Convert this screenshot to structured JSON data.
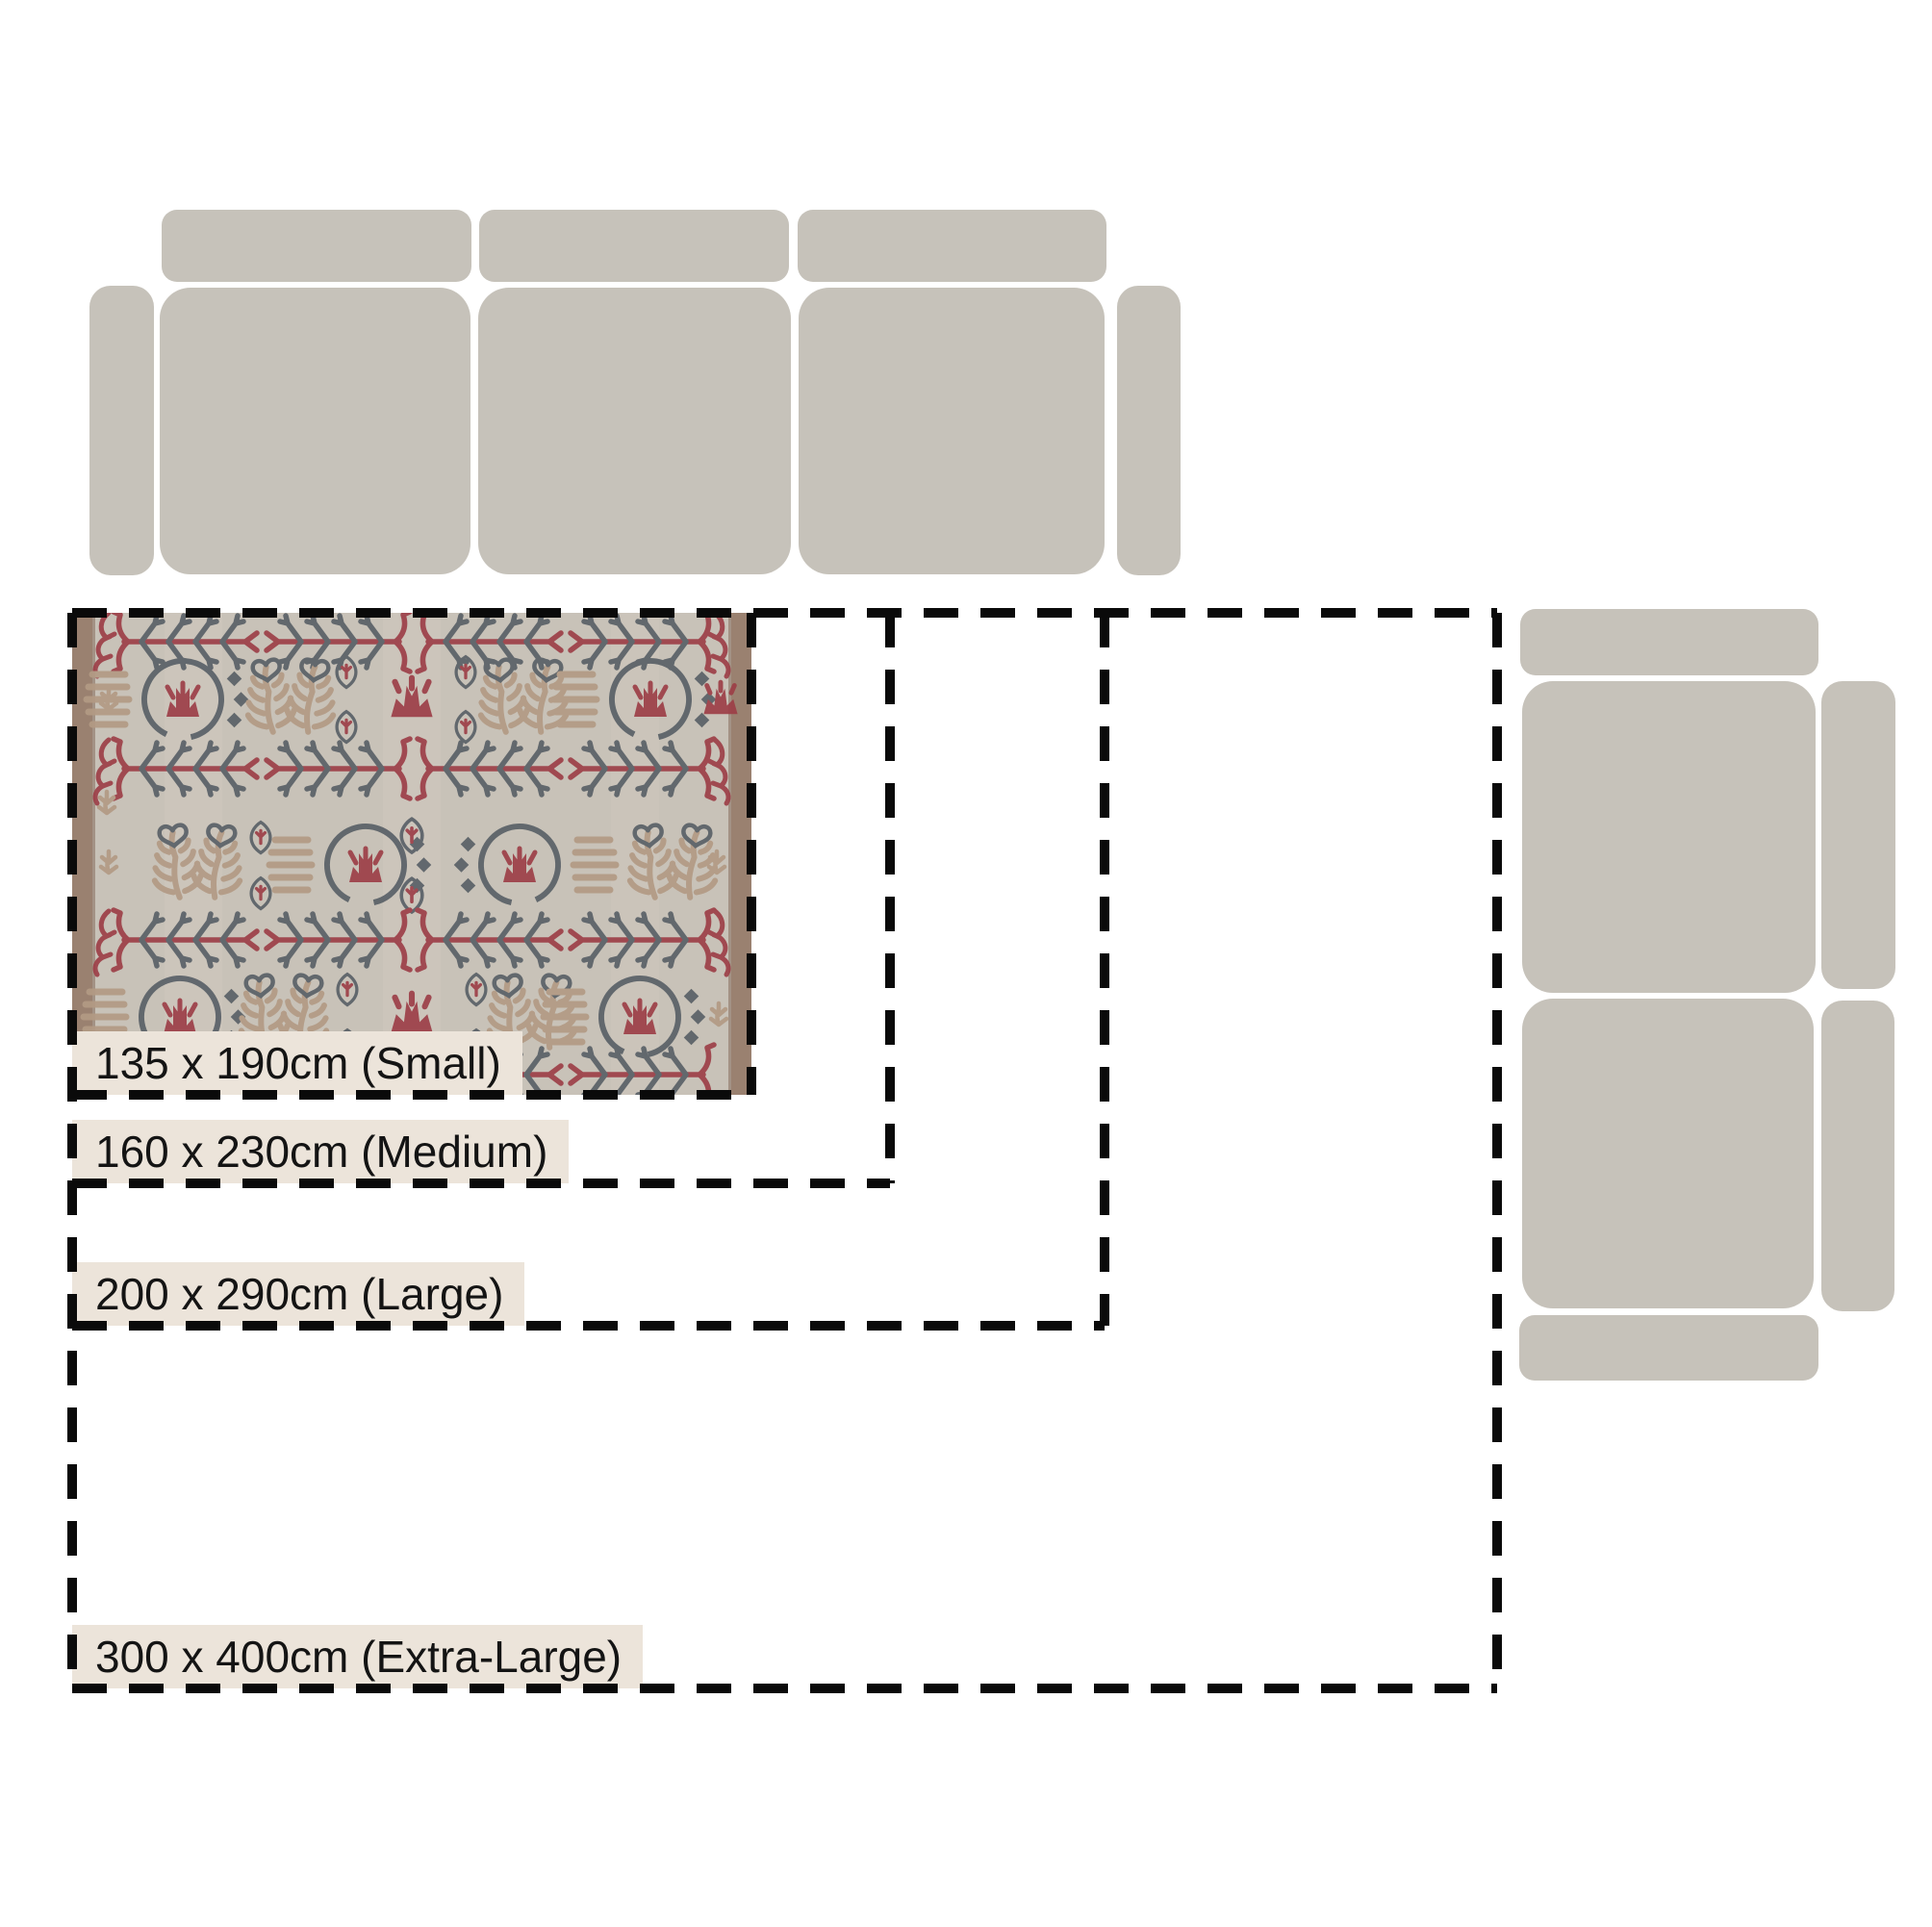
{
  "sizes": [
    {
      "name": "Small",
      "width_cm": 135,
      "length_cm": 190,
      "label": "135 x 190cm (Small)"
    },
    {
      "name": "Medium",
      "width_cm": 160,
      "length_cm": 230,
      "label": "160 x 230cm (Medium)"
    },
    {
      "name": "Large",
      "width_cm": 200,
      "length_cm": 290,
      "label": "200 x 290cm (Large)"
    },
    {
      "name": "Extra-Large",
      "width_cm": 300,
      "length_cm": 400,
      "label": "300 x 400cm (Extra-Large)"
    }
  ],
  "furniture": {
    "top_sofa": "three-seat-sofa-top-view",
    "right_sofa": "two-seat-sectional-sofa-top-view"
  },
  "colors": {
    "background": "#ffffff",
    "sofa_fill": "#c6c2ba",
    "outline_dash": "#0a0a0a",
    "label_background": "#ece4da",
    "label_text": "#141414",
    "rug_field": "#c8c2b8",
    "rug_side_border": "#9a8170",
    "rug_red": "#9c3f47",
    "rug_slate": "#596067",
    "rug_tan": "#b29a84"
  }
}
